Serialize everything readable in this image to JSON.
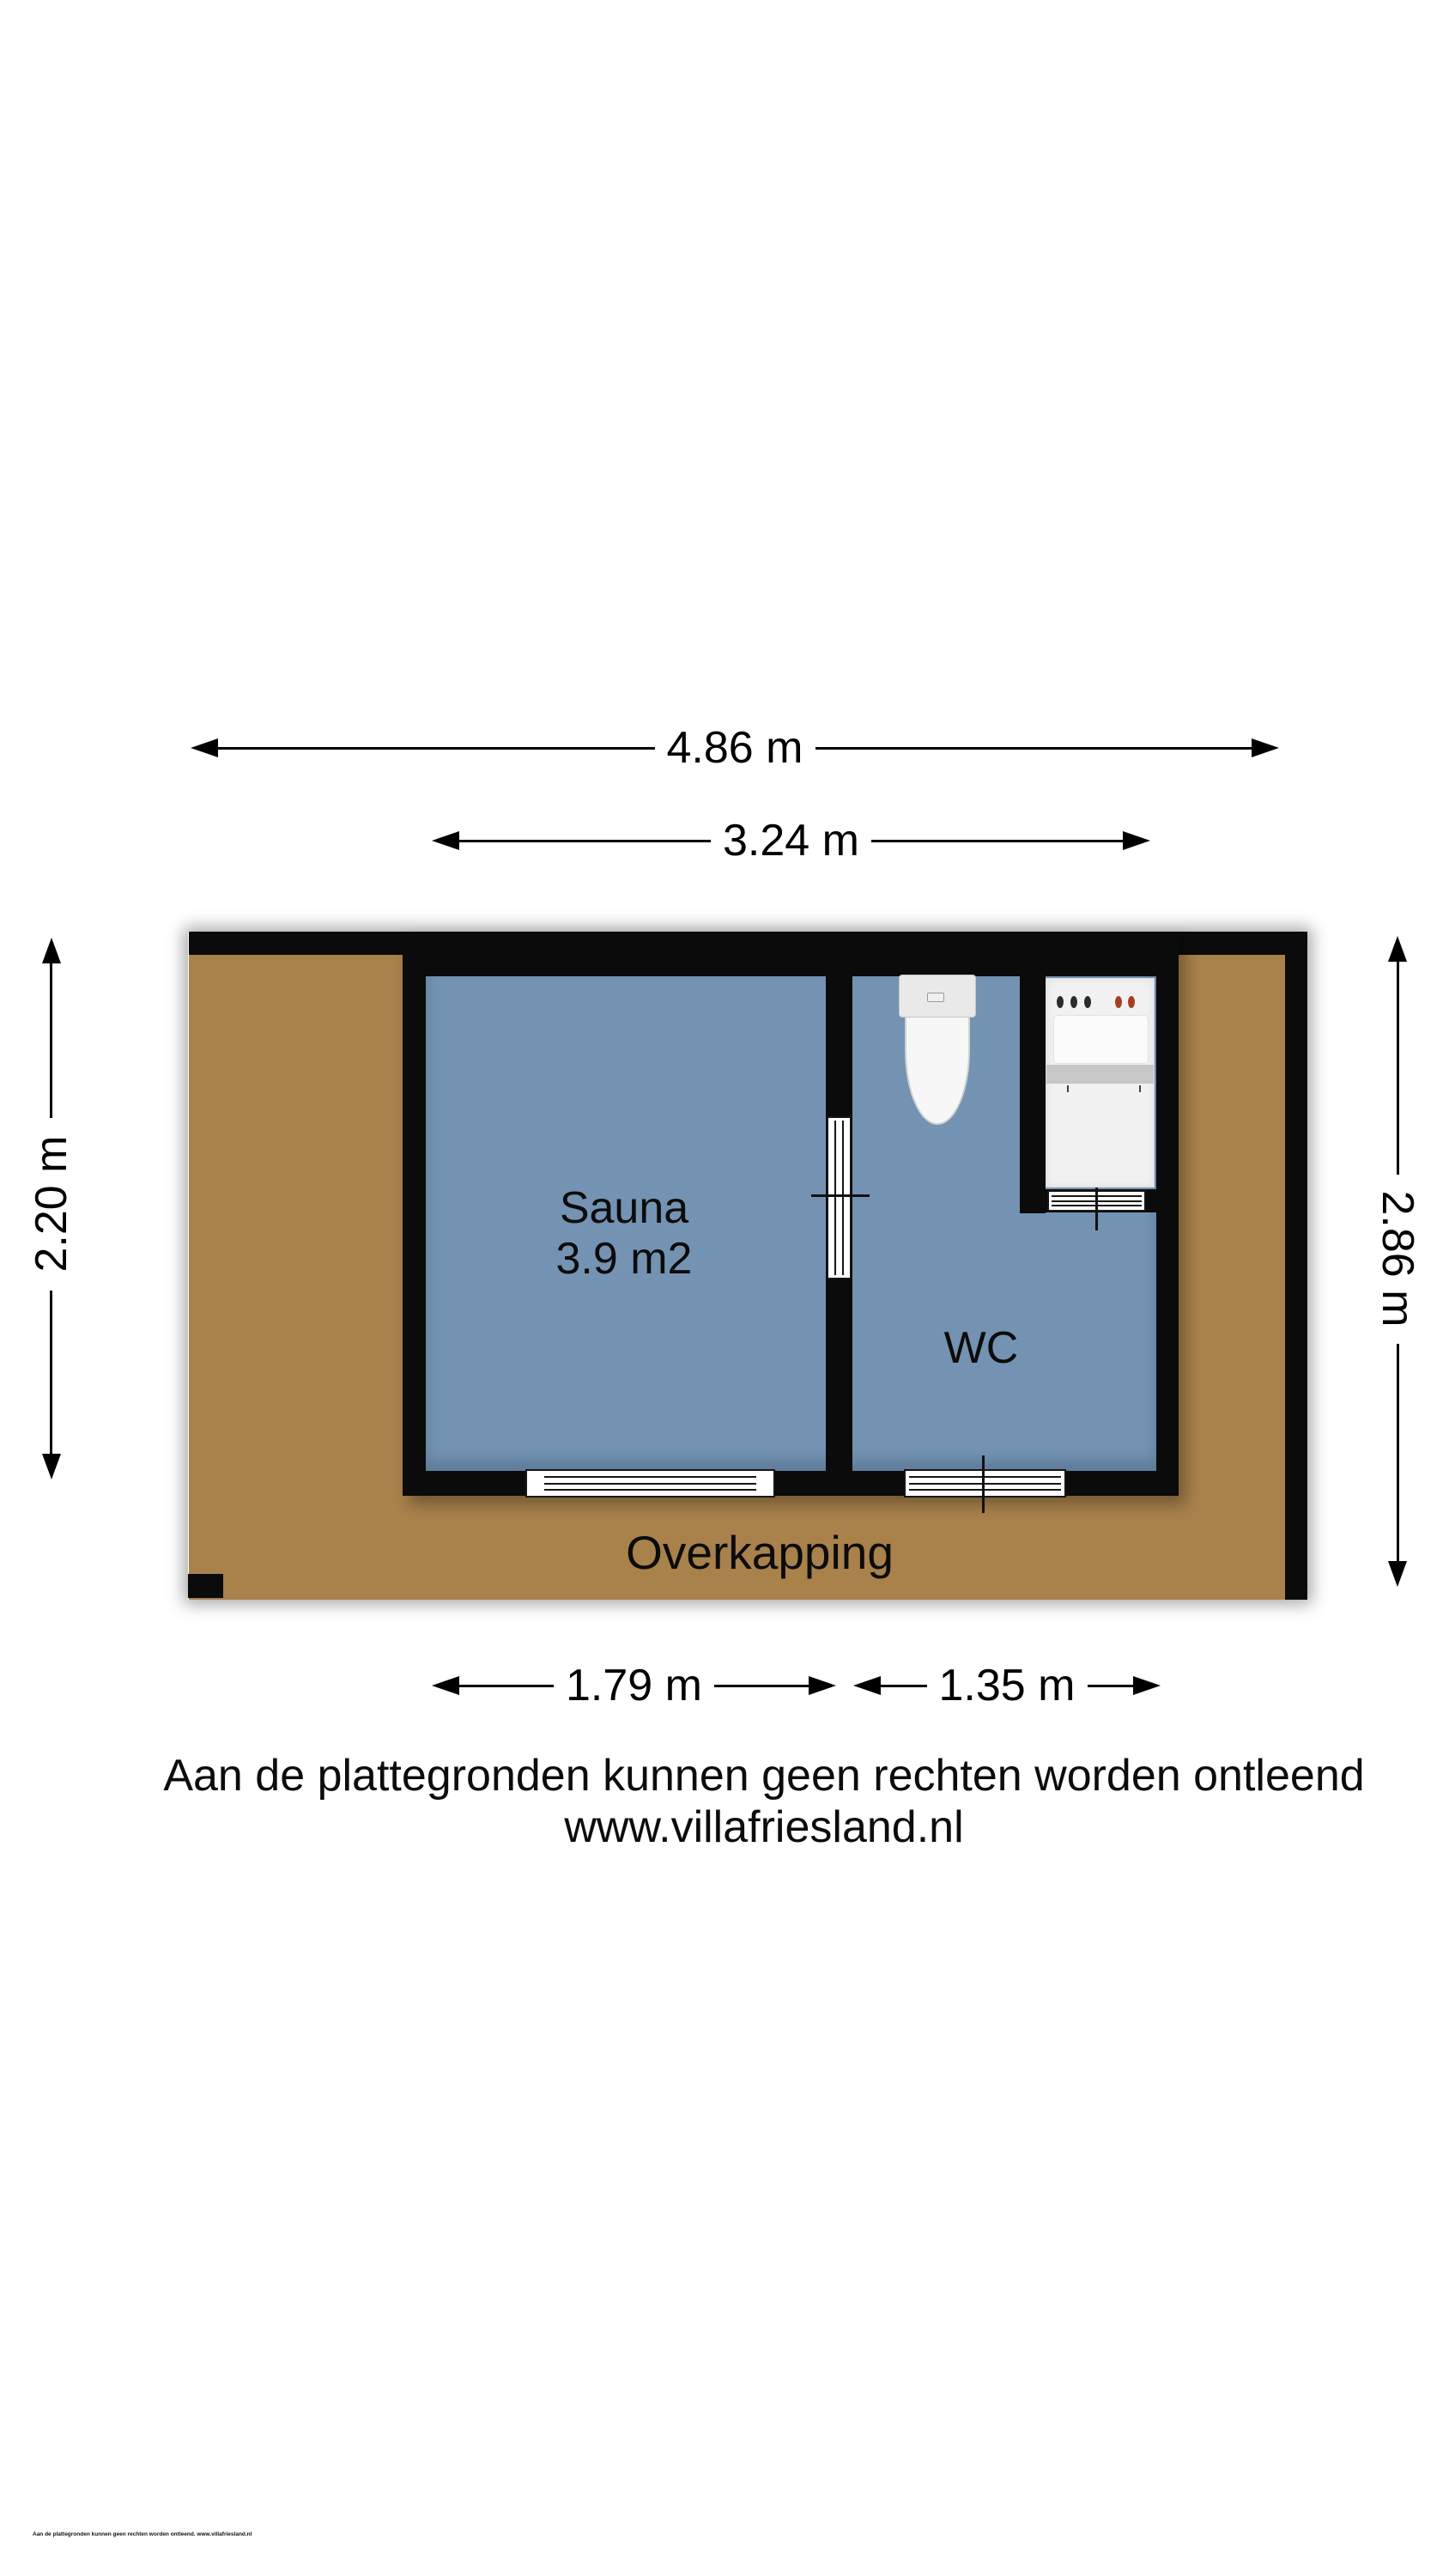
{
  "plan": {
    "rooms": {
      "sauna": {
        "label": "Sauna",
        "area": "3.9 m2"
      },
      "wc": {
        "label": "WC"
      },
      "overkapping": {
        "label": "Overkapping"
      }
    },
    "fixtures": [
      "toilet-icon",
      "washing-machine-icon"
    ]
  },
  "dimensions": {
    "total_width": "4.86 m",
    "inner_width": "3.24 m",
    "left_height": "2.20 m",
    "right_height": "2.86 m",
    "sauna_width": "1.79 m",
    "wc_width": "1.35 m"
  },
  "disclaimer": {
    "line1": "Aan de plattegronden kunnen geen rechten worden ontleend",
    "line2": "www.villafriesland.nl"
  },
  "fineprint": "Aan de plattegronden kunnen geen rechten worden ontleend. www.villafriesland.nl",
  "colors": {
    "floor": "#A8814B",
    "room": "#7493B3",
    "wall": "#0B0B0B",
    "fixture": "#F1F1F1",
    "knob_dark": "#2B2B2B",
    "knob_red": "#A63D22"
  }
}
